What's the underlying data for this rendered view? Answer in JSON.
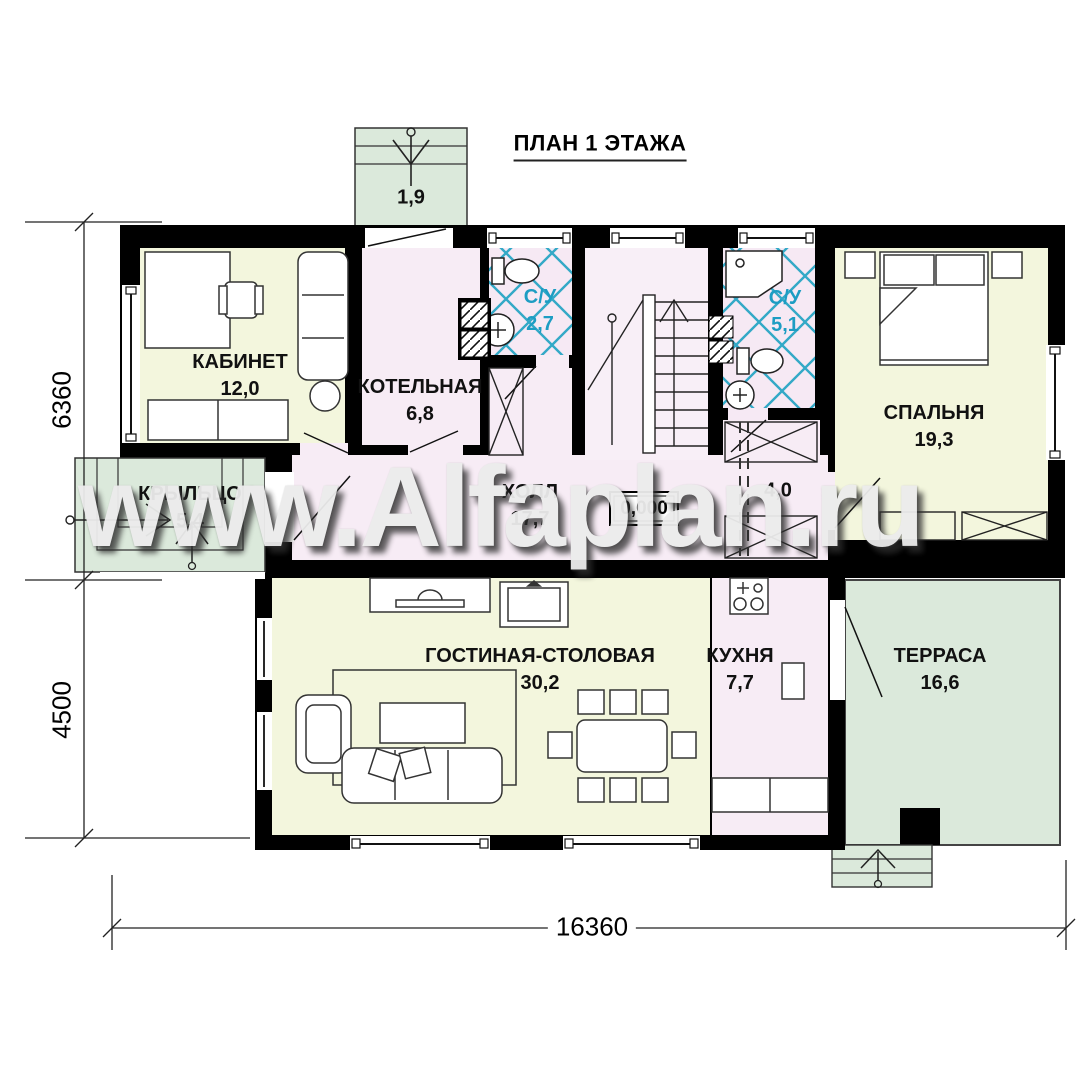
{
  "title": "ПЛАН 1 ЭТАЖА",
  "watermark": "www.Alfaplan.ru",
  "elevation_mark": "0,000",
  "rooms": {
    "entry_porch": {
      "area": "1,9"
    },
    "kabinet": {
      "name": "КАБИНЕТ",
      "area": "12,0"
    },
    "kotelnaya": {
      "name": "КОТЕЛЬНАЯ",
      "area": "6,8"
    },
    "su_small": {
      "name": "С/У",
      "area": "2,7"
    },
    "su_big": {
      "name": "С/У",
      "area": "5,1"
    },
    "spalnya": {
      "name": "СПАЛЬНЯ",
      "area": "19,3"
    },
    "kryltso": {
      "name": "КРЫЛЬЦО",
      "area": "5,4"
    },
    "holl": {
      "name": "ХОЛЛ",
      "area": "17,7"
    },
    "corridor": {
      "area": "4,0"
    },
    "gostinaya": {
      "name": "ГОСТИНАЯ-СТОЛОВАЯ",
      "area": "30,2"
    },
    "kuhnya": {
      "name": "КУХНЯ",
      "area": "7,7"
    },
    "terrasa": {
      "name": "ТЕРРАСА",
      "area": "16,6"
    }
  },
  "dimensions": {
    "left_top": "6360",
    "left_bottom": "4500",
    "bottom": "16360"
  },
  "colors": {
    "wall": "#000000",
    "room_cream": "#f3f6dd",
    "room_pink": "#f7ecf5",
    "porch_green": "#dbe9db",
    "tile_blue": "#33a9c7"
  }
}
